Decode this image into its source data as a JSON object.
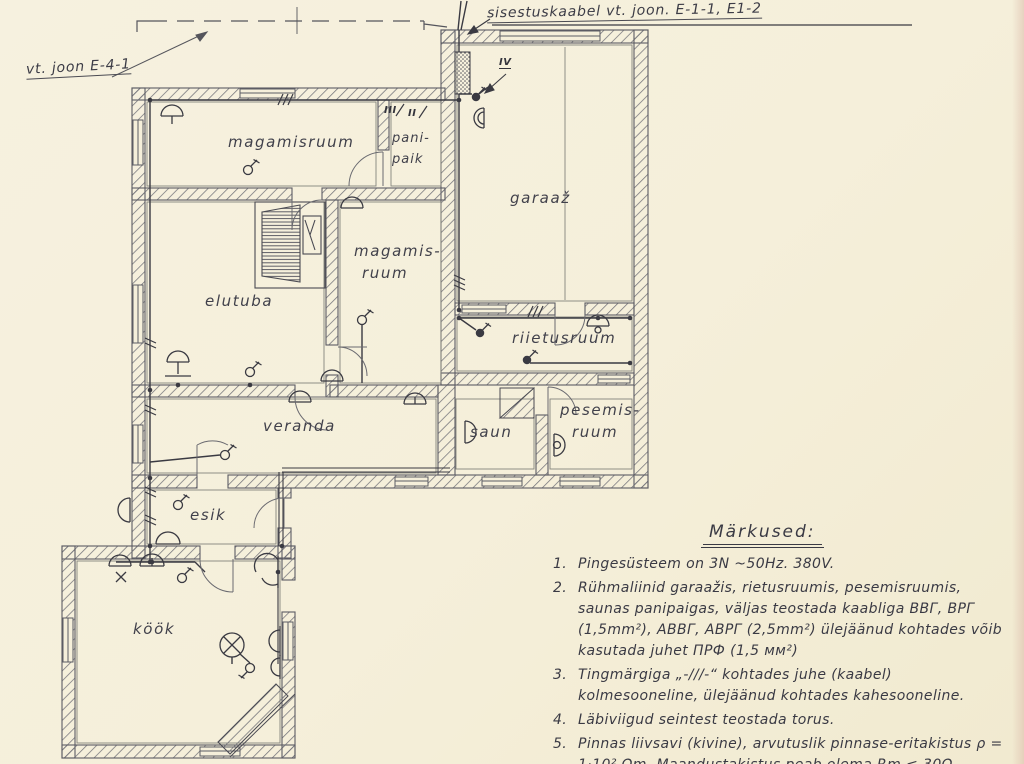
{
  "annotations": {
    "service_cable": "sisestuskaabel vt. joon. E-1-1, E1-2",
    "ref_drawing": "vt. joon E-4-1",
    "group_iii": "III",
    "group_ii": "II",
    "group_iv": "IV"
  },
  "rooms": {
    "magamisruum1": "magamisruum",
    "panipaik1": "pani-",
    "panipaik2": "paik",
    "garaaz": "garaaž",
    "elutuba": "elutuba",
    "magamisruum2a": "magamis-",
    "magamisruum2b": "ruum",
    "riietusruum": "riietusruum",
    "veranda": "veranda",
    "saun": "saun",
    "pesemisruum1": "pesemis-",
    "pesemisruum2": "ruum",
    "esik": "esik",
    "kook": "köök"
  },
  "notes": {
    "title": "Märkused:",
    "items": [
      {
        "num": "1.",
        "text": "Pingesüsteem on 3N ~50Hz. 380V."
      },
      {
        "num": "2.",
        "text": "Rühmaliinid garaažis, rietusruumis, pesemisruumis, saunas panipaigas, väljas teostada kaabliga ВВГ, ВРГ (1,5mm²), АВВГ, АВРГ (2,5mm²) ülejäänud kohtades võib kasutada juhet ПРФ (1,5 мм²)"
      },
      {
        "num": "3.",
        "text": "Tingmärgiga „-///-“ kohtades juhe (kaabel) kolmesooneline, ülejäänud kohtades kahesooneline."
      },
      {
        "num": "4.",
        "text": "Läbiviigud seintest teostada torus."
      },
      {
        "num": "5.",
        "text": "Pinnas liivsavi (kivine), arvutuslik pinnase-eritakistus ρ = 1·10² Ωm. Maandustakistus peab olema Rm ≤ 30Ω."
      }
    ]
  },
  "colors": {
    "paper": "#f5efda",
    "ink": "#3a3a44",
    "pencil": "#5c5c64"
  }
}
